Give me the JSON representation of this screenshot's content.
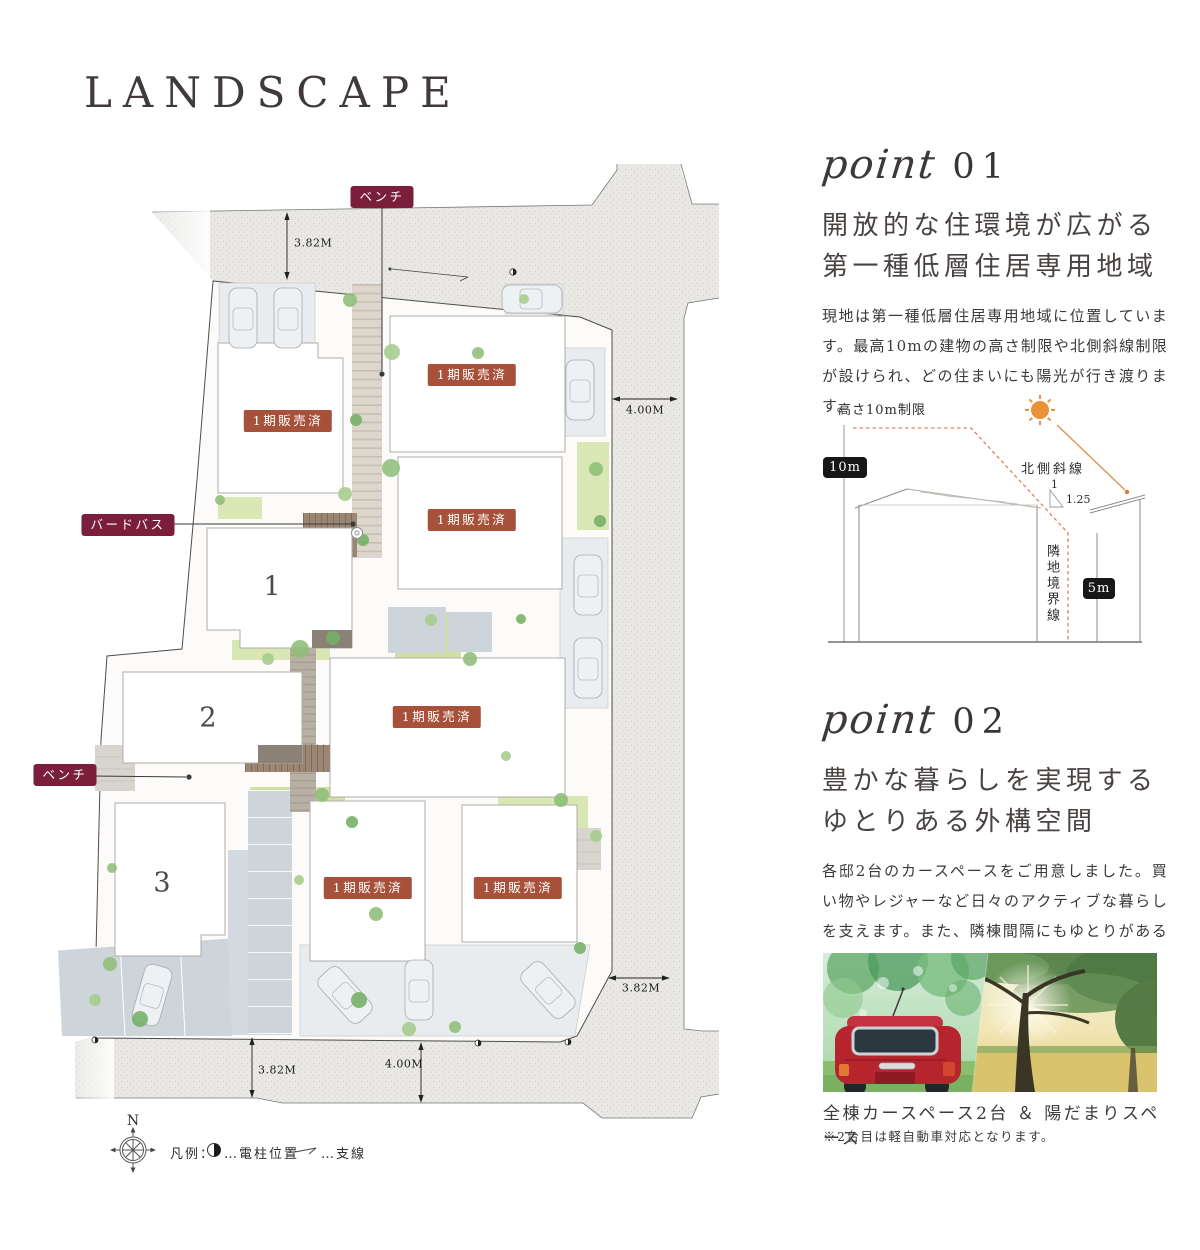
{
  "page": {
    "title": "LANDSCAPE"
  },
  "colors": {
    "badge_wine": "#7b1e3c",
    "badge_brick": "#a7513b",
    "measure_badge_black": "#171717",
    "sun_orange": "#e8923a",
    "dashed_limit_orange": "#dd6a45",
    "road_gray": "#e9e8e5"
  },
  "site_plan": {
    "badges": [
      {
        "name": "bench-label-top",
        "label": "ベンチ",
        "type": "wine",
        "x": 382,
        "y": 197
      },
      {
        "name": "sold-label-1",
        "label": "1期販売済",
        "type": "brick",
        "x": 288,
        "y": 421
      },
      {
        "name": "sold-label-2",
        "label": "1期販売済",
        "type": "brick",
        "x": 472,
        "y": 375
      },
      {
        "name": "sold-label-3",
        "label": "1期販売済",
        "type": "brick",
        "x": 472,
        "y": 520
      },
      {
        "name": "birdbath-label",
        "label": "バードバス",
        "type": "wine",
        "x": 128,
        "y": 525
      },
      {
        "name": "sold-label-4",
        "label": "1期販売済",
        "type": "brick",
        "x": 437,
        "y": 717
      },
      {
        "name": "bench-label-left",
        "label": "ベンチ",
        "type": "wine",
        "x": 65,
        "y": 775
      },
      {
        "name": "sold-label-5",
        "label": "1期販売済",
        "type": "brick",
        "x": 368,
        "y": 888
      },
      {
        "name": "sold-label-6",
        "label": "1期販売済",
        "type": "brick",
        "x": 518,
        "y": 888
      }
    ],
    "lots": [
      {
        "name": "lot-number-1",
        "number": "1",
        "x": 272,
        "y": 587
      },
      {
        "name": "lot-number-2",
        "number": "2",
        "x": 208,
        "y": 718
      },
      {
        "name": "lot-number-3",
        "number": "3",
        "x": 162,
        "y": 883
      }
    ],
    "dimensions": [
      {
        "name": "dim-top-left",
        "label": "3.82M",
        "x": 294,
        "y": 243,
        "align": "left"
      },
      {
        "name": "dim-right-upper",
        "label": "4.00M",
        "x": 645,
        "y": 410,
        "align": "center"
      },
      {
        "name": "dim-right-lower",
        "label": "3.82M",
        "x": 641,
        "y": 988,
        "align": "center"
      },
      {
        "name": "dim-bottom-left",
        "label": "3.82M",
        "x": 258,
        "y": 1070,
        "align": "left"
      },
      {
        "name": "dim-bottom-right",
        "label": "4.00M",
        "x": 404,
        "y": 1064,
        "align": "center"
      }
    ],
    "legend": {
      "title": "凡例：",
      "pole_label": "…電柱位置",
      "wire_label": "…支線"
    },
    "compass": {
      "north": "N"
    }
  },
  "points": [
    {
      "kicker": "point",
      "number": "01",
      "heading_lines": [
        "開放的な住環境が広がる",
        "第一種低層住居専用地域"
      ],
      "body": "現地は第一種低層住居専用地域に位置しています。最高10mの建物の高さ制限や北側斜線制限が設けられ、どの住まいにも陽光が行き渡ります。"
    },
    {
      "kicker": "point",
      "number": "02",
      "heading_lines": [
        "豊かな暮らしを実現する",
        "ゆとりある外構空間"
      ],
      "body": "各邸2台のカースペースをご用意しました。買い物やレジャーなど日々のアクティブな暮らしを支えます。また、隣棟間隔にもゆとりがあるため各邸に温かな光が注ぎ込みます。"
    }
  ],
  "diagram": {
    "height_limit_label": "高さ10m制限",
    "ten_m": "10m",
    "north_slope_label": "北側斜線",
    "ratio_top": "1",
    "ratio_value": "1.25",
    "boundary_label": "隣地境界線",
    "five_m": "5m"
  },
  "photo": {
    "caption": "全棟カースペース2台 ＆ 陽だまりスペース",
    "note": "※2台目は軽自動車対応となります。"
  }
}
